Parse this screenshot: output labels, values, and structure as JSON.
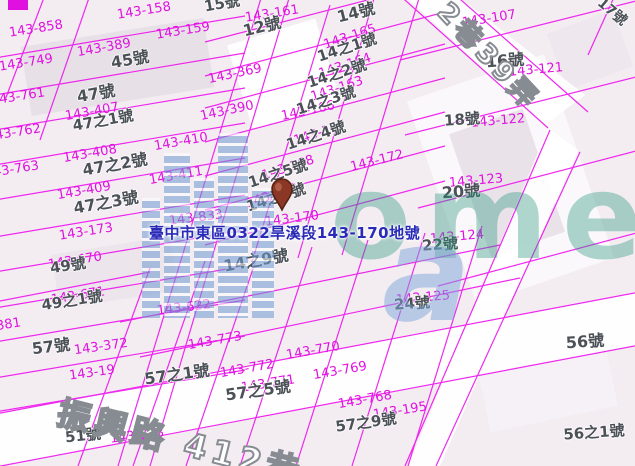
{
  "info_label": {
    "text": "臺中市東區0322旱溪段143-170地號",
    "color": "#2a2ab8"
  },
  "colors": {
    "parcel_line": "#ee12ee",
    "parcel_number_text": "#e011e0",
    "house_number_text": "#4b5157",
    "info_label_text": "#2a2ab8",
    "background": "#f3edf2",
    "watermark_teal": "#2d967d",
    "watermark_blue": "#7da5d7",
    "pin_fill": "#8a3726"
  },
  "roads": [
    {
      "name": "2巷39弄",
      "x": 452,
      "y": -2,
      "rot": 47,
      "size": 27
    },
    {
      "name": "振興路 412巷",
      "x": 62,
      "y": 396,
      "rot": 14,
      "size": 33
    }
  ],
  "watermark": {
    "letters_teal": "ome",
    "letter_blue": "a"
  },
  "pin": {
    "marks_parcel": "143-170"
  },
  "parcel_labels": [
    {
      "t": "143-158",
      "x": 144,
      "y": 11,
      "r": -9
    },
    {
      "t": "143-159",
      "x": 183,
      "y": 31,
      "r": -9
    },
    {
      "t": "143-161",
      "x": 272,
      "y": 14,
      "r": -9
    },
    {
      "t": "143-858",
      "x": 36,
      "y": 29,
      "r": -9
    },
    {
      "t": "143-389",
      "x": 104,
      "y": 48,
      "r": -10
    },
    {
      "t": "143-749",
      "x": 26,
      "y": 63,
      "r": -9
    },
    {
      "t": "143-761",
      "x": 18,
      "y": 97,
      "r": -9
    },
    {
      "t": "143-762",
      "x": 14,
      "y": 133,
      "r": -9
    },
    {
      "t": "143-763",
      "x": 12,
      "y": 170,
      "r": -9
    },
    {
      "t": "143-407",
      "x": 92,
      "y": 112,
      "r": -10
    },
    {
      "t": "143-408",
      "x": 90,
      "y": 154,
      "r": -10
    },
    {
      "t": "143-409",
      "x": 84,
      "y": 191,
      "r": -10
    },
    {
      "t": "143-410",
      "x": 181,
      "y": 142,
      "r": -10
    },
    {
      "t": "143-411",
      "x": 176,
      "y": 176,
      "r": -10
    },
    {
      "t": "143-173",
      "x": 86,
      "y": 232,
      "r": -9
    },
    {
      "t": "143-833",
      "x": 196,
      "y": 218,
      "r": -7
    },
    {
      "t": "143-170",
      "x": 292,
      "y": 219,
      "r": -7
    },
    {
      "t": "143-369",
      "x": 235,
      "y": 74,
      "r": -12
    },
    {
      "t": "143-390",
      "x": 227,
      "y": 111,
      "r": -12
    },
    {
      "t": "143-166",
      "x": 308,
      "y": 111,
      "r": -12
    },
    {
      "t": "143-165",
      "x": 350,
      "y": 37,
      "r": -18
    },
    {
      "t": "143-164",
      "x": 345,
      "y": 66,
      "r": -18
    },
    {
      "t": "143-163",
      "x": 337,
      "y": 89,
      "r": -18
    },
    {
      "t": "143-167",
      "x": 320,
      "y": 133,
      "r": -18
    },
    {
      "t": "143-168",
      "x": 288,
      "y": 168,
      "r": -18
    },
    {
      "t": "143-169",
      "x": 272,
      "y": 196,
      "r": -18
    },
    {
      "t": "143-172",
      "x": 377,
      "y": 161,
      "r": -14
    },
    {
      "t": "143-107",
      "x": 489,
      "y": 19,
      "r": -9
    },
    {
      "t": "143-121",
      "x": 536,
      "y": 70,
      "r": -5
    },
    {
      "t": "143-122",
      "x": 498,
      "y": 121,
      "r": -5
    },
    {
      "t": "143-123",
      "x": 476,
      "y": 181,
      "r": -5
    },
    {
      "t": "143-124",
      "x": 457,
      "y": 237,
      "r": -5
    },
    {
      "t": "143-125",
      "x": 423,
      "y": 298,
      "r": -5
    },
    {
      "t": "143-622",
      "x": 184,
      "y": 308,
      "r": -7
    },
    {
      "t": "143-372",
      "x": 101,
      "y": 347,
      "r": -8
    },
    {
      "t": "143-19",
      "x": 92,
      "y": 373,
      "r": -8
    },
    {
      "t": "143-773",
      "x": 215,
      "y": 341,
      "r": -10
    },
    {
      "t": "143-772",
      "x": 247,
      "y": 369,
      "r": -10
    },
    {
      "t": "143-771",
      "x": 268,
      "y": 384,
      "r": -9
    },
    {
      "t": "143-770",
      "x": 313,
      "y": 351,
      "r": -10
    },
    {
      "t": "143-769",
      "x": 340,
      "y": 371,
      "r": -10
    },
    {
      "t": "143-768",
      "x": 365,
      "y": 400,
      "r": -10
    },
    {
      "t": "143-195",
      "x": 400,
      "y": 411,
      "r": -9
    },
    {
      "t": "143-628",
      "x": 137,
      "y": 436,
      "r": -7
    },
    {
      "t": "143-381",
      "x": -6,
      "y": 327,
      "r": -9
    },
    {
      "t": "143-670",
      "x": 75,
      "y": 261,
      "r": -9
    },
    {
      "t": "143-671",
      "x": 78,
      "y": 296,
      "r": -9
    }
  ],
  "house_labels": [
    {
      "t": "15號",
      "x": 222,
      "y": 4,
      "r": -10,
      "s": 15
    },
    {
      "t": "12號",
      "x": 262,
      "y": 27,
      "r": -14,
      "s": 16
    },
    {
      "t": "14號",
      "x": 356,
      "y": 13,
      "r": -14,
      "s": 16
    },
    {
      "t": "14之1號",
      "x": 347,
      "y": 48,
      "r": -18,
      "s": 15
    },
    {
      "t": "14之2號",
      "x": 337,
      "y": 74,
      "r": -18,
      "s": 15
    },
    {
      "t": "14之3號",
      "x": 326,
      "y": 101,
      "r": -18,
      "s": 15
    },
    {
      "t": "14之4號",
      "x": 316,
      "y": 136,
      "r": -18,
      "s": 15
    },
    {
      "t": "14之5號",
      "x": 278,
      "y": 174,
      "r": -18,
      "s": 15
    },
    {
      "t": "14之6號",
      "x": 276,
      "y": 198,
      "r": -18,
      "s": 15
    },
    {
      "t": "14之9號",
      "x": 256,
      "y": 261,
      "r": -10,
      "s": 16
    },
    {
      "t": "45號",
      "x": 130,
      "y": 60,
      "r": -10,
      "s": 16
    },
    {
      "t": "47號",
      "x": 96,
      "y": 94,
      "r": -10,
      "s": 16
    },
    {
      "t": "47之1號",
      "x": 103,
      "y": 121,
      "r": -10,
      "s": 15
    },
    {
      "t": "47之2號",
      "x": 115,
      "y": 165,
      "r": -10,
      "s": 16
    },
    {
      "t": "47之3號",
      "x": 106,
      "y": 203,
      "r": -10,
      "s": 16
    },
    {
      "t": "49號",
      "x": 68,
      "y": 266,
      "r": -9,
      "s": 15
    },
    {
      "t": "49之1號",
      "x": 72,
      "y": 301,
      "r": -9,
      "s": 15
    },
    {
      "t": "57號",
      "x": 51,
      "y": 347,
      "r": -7,
      "s": 16
    },
    {
      "t": "57之1號",
      "x": 177,
      "y": 375,
      "r": -8,
      "s": 16
    },
    {
      "t": "57之5號",
      "x": 258,
      "y": 391,
      "r": -8,
      "s": 16
    },
    {
      "t": "57之9號",
      "x": 366,
      "y": 423,
      "r": -8,
      "s": 15
    },
    {
      "t": "51號",
      "x": 83,
      "y": 436,
      "r": -6,
      "s": 15
    },
    {
      "t": "16號",
      "x": 505,
      "y": 61,
      "r": -4,
      "s": 16
    },
    {
      "t": "17號",
      "x": 612,
      "y": 12,
      "r": 40,
      "s": 14
    },
    {
      "t": "18號",
      "x": 462,
      "y": 120,
      "r": -4,
      "s": 15
    },
    {
      "t": "20號",
      "x": 461,
      "y": 192,
      "r": -4,
      "s": 16
    },
    {
      "t": "22號",
      "x": 440,
      "y": 245,
      "r": -4,
      "s": 15
    },
    {
      "t": "24號",
      "x": 412,
      "y": 304,
      "r": -4,
      "s": 15
    },
    {
      "t": "56號",
      "x": 585,
      "y": 342,
      "r": -4,
      "s": 16
    },
    {
      "t": "56之1號",
      "x": 594,
      "y": 433,
      "r": -4,
      "s": 15
    }
  ]
}
